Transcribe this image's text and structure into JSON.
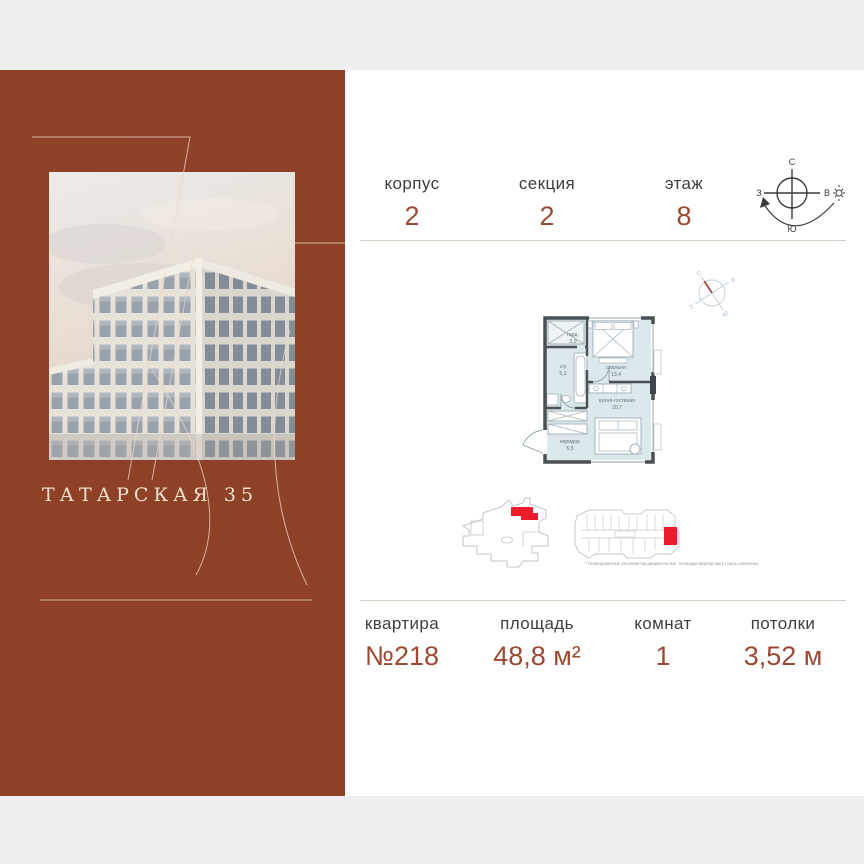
{
  "card": {
    "brand_title": "ТАТАРСКАЯ 35",
    "colors": {
      "panel": "#8e4127",
      "accent": "#9c4a33",
      "label": "#3d3e40",
      "highlight_red": "#ec1c2d"
    },
    "header": {
      "stats": [
        {
          "label": "корпус",
          "value": "2"
        },
        {
          "label": "секция",
          "value": "2"
        },
        {
          "label": "этаж",
          "value": "8"
        }
      ],
      "compass": {
        "n": "С",
        "s": "Ю",
        "w": "З",
        "e": "В"
      }
    },
    "plan": {
      "rooms": [
        {
          "name": "гард.",
          "area": "3,9"
        },
        {
          "name": "с/у",
          "area": "5,2"
        },
        {
          "name": "спальня",
          "area": "13,4"
        },
        {
          "name": "кухня-гостиная",
          "area": "20,7"
        },
        {
          "name": "коридор",
          "area": "5,5"
        }
      ],
      "mini_compass": {
        "n": "С",
        "s": "Ю",
        "w": "З",
        "e": "В"
      },
      "disclaimer": "* Планировочные решения предварительные, площади квартир могут быть изменены"
    },
    "details": {
      "stats": [
        {
          "label": "квартира",
          "value": "№218"
        },
        {
          "label": "площадь",
          "value": "48,8 м²"
        },
        {
          "label": "комнат",
          "value": "1"
        },
        {
          "label": "потолки",
          "value": "3,52 м"
        }
      ]
    }
  }
}
